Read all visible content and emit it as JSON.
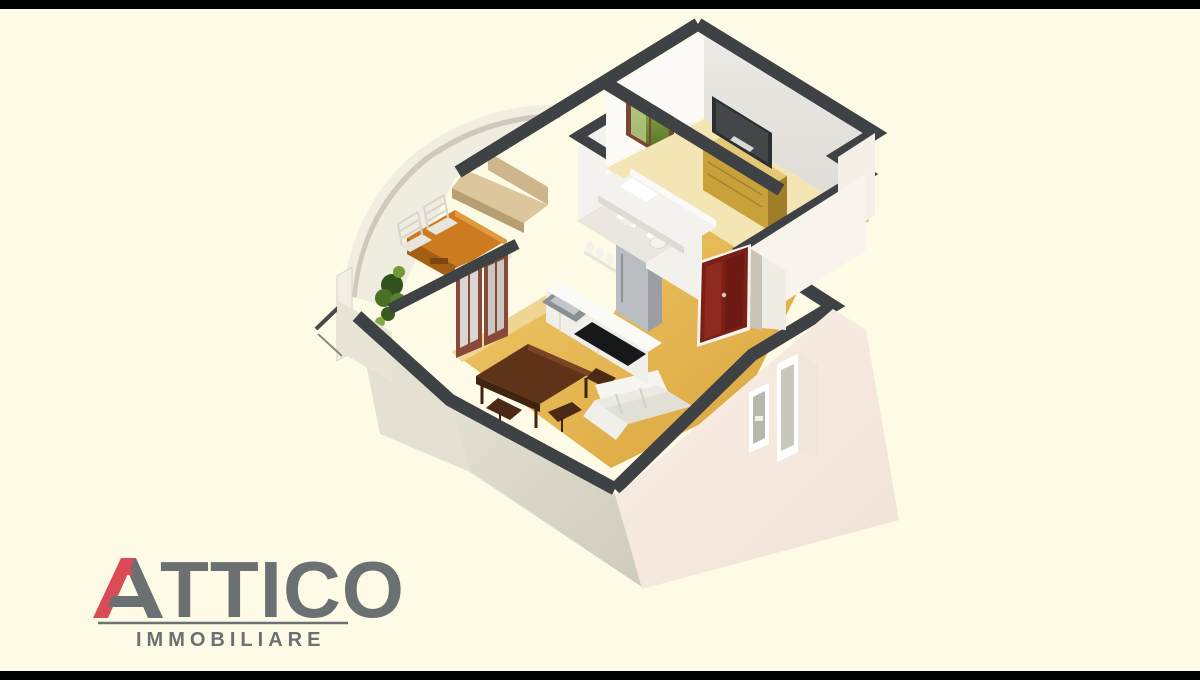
{
  "brand": {
    "name": "ATTICO",
    "name_rest": "TTICO",
    "tagline": "IMMOBILIARE",
    "accent_color": "#d84b57",
    "text_color": "#6b7073"
  },
  "frame": {
    "bar_color": "#000000",
    "background_color": "#fdfae6"
  },
  "floorplan": {
    "type": "isometric-3d-apartment-render",
    "rooms": [
      {
        "id": "bedroom",
        "title": "Bedroom",
        "furniture": [
          "double bed",
          "dresser",
          "flat screen TV",
          "window with garden view"
        ]
      },
      {
        "id": "bathroom",
        "title": "Bathroom",
        "furniture": [
          "washbasin",
          "toilet",
          "mirror"
        ]
      },
      {
        "id": "kitchen",
        "title": "Kitchen",
        "furniture": [
          "counter with sink",
          "cooktop",
          "refrigerator",
          "wall shelf with jars"
        ]
      },
      {
        "id": "living-dining",
        "title": "Living / Dining room",
        "furniture": [
          "dark wood dining table",
          "chairs",
          "white corner sofa",
          "french doors to balcony"
        ]
      },
      {
        "id": "entry-hall",
        "title": "Entry hall",
        "furniture": [
          "dark red front door"
        ]
      },
      {
        "id": "balcony",
        "title": "Curved balcony terrace",
        "furniture": [
          "wooden outdoor table",
          "slatted chairs",
          "beige bench",
          "green plants",
          "railing"
        ]
      }
    ],
    "palette": {
      "wall_cap": "#3e4245",
      "exterior_right": "#f7ebe2",
      "exterior_left": "#dcd9ca",
      "floor_gold": "#e7bb55",
      "floor_pale": "#f4e5b5",
      "orange_wall": "#c4662e",
      "front_door": "#7c1f17",
      "wood_table": "#cd7b1f",
      "dining_table": "#5f3318",
      "sofa": "#efede7",
      "plant_green": "#4a7026",
      "tv": "#2c2f31"
    }
  }
}
